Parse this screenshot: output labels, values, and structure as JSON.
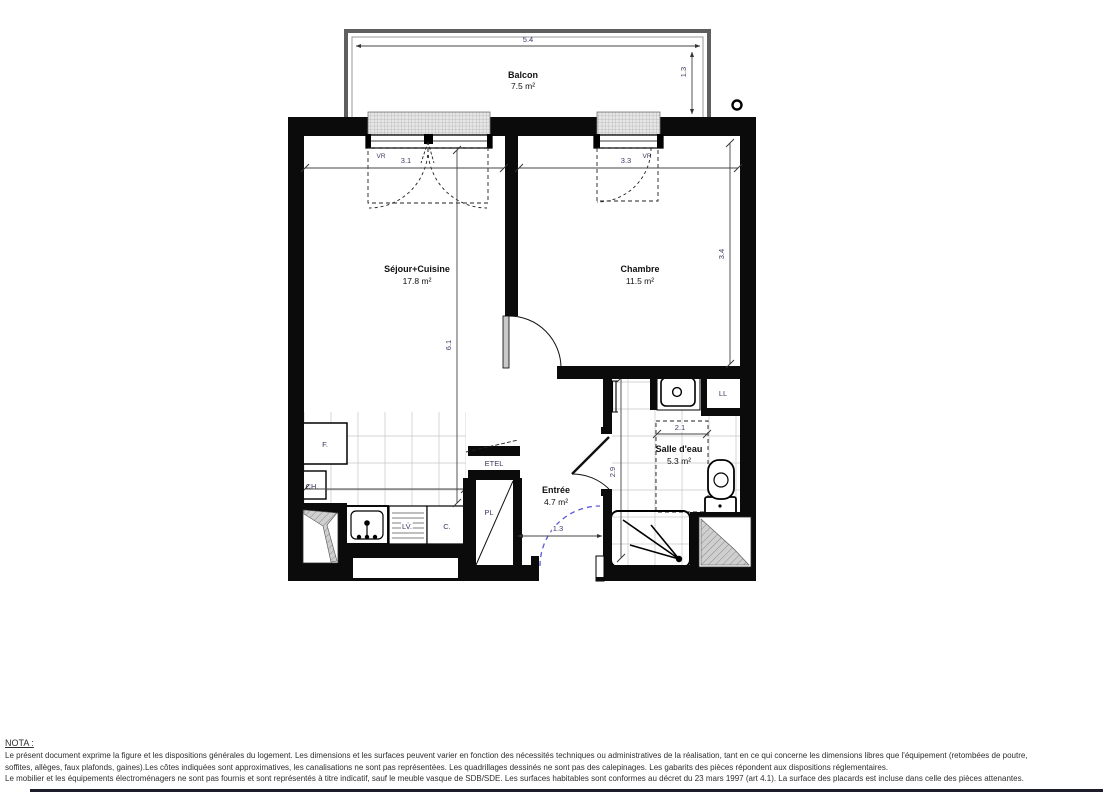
{
  "plan": {
    "rooms": {
      "balcon": {
        "name": "Balcon",
        "area": "7.5 m²"
      },
      "sejour": {
        "name": "Séjour+Cuisine",
        "area": "17.8 m²"
      },
      "chambre": {
        "name": "Chambre",
        "area": "11.5 m²"
      },
      "entree": {
        "name": "Entrée",
        "area": "4.7 m²"
      },
      "salle_eau": {
        "name": "Salle d'eau",
        "area": "5.3 m²"
      }
    },
    "dimensions": {
      "balcon_width": "5.4",
      "balcon_depth": "1.3",
      "sejour_window_width": "3.1",
      "chambre_window_width": "3.3",
      "sejour_length": "6.1",
      "chambre_depth": "3.4",
      "cuisine_width": "2.5",
      "entree_door_width": "1.3",
      "salle_eau_width": "2.1",
      "salle_eau_depth": "2.9"
    },
    "equipment": {
      "fridge": "F.",
      "water_heater": "CH.",
      "dishwasher": "LV.",
      "cooker": "C.",
      "electrical_panel": "ETEL",
      "closet": "PL",
      "washing_machine": "LL",
      "roller_shutter": "VR"
    }
  },
  "nota": {
    "title": "NOTA :",
    "line1": "Le présent document exprime la figure et les dispositions générales du logement. Les dimensions et les surfaces peuvent varier en fonction des nécessités techniques ou administratives de la réalisation, tant en ce qui concerne les dimensions libres que l'équipement (retombées de poutre,",
    "line2": "soffites, allèges, faux plafonds, gaines).Les côtes indiquées sont approximatives, les canalisations ne sont pas représentées. Les quadrillages dessinés ne sont pas des calepinages. Les gabarits des pièces répondent aux dispositions réglementaires.",
    "line3": "Le mobilier et les équipements électroménagers ne sont pas fournis et sont représentés à titre indicatif, sauf le meuble vasque de SDB/SDE. Les surfaces habitables sont conformes au décret du 23 mars 1997 (art 4.1). La surface des placards est incluse dans celle des pièces attenantes."
  }
}
